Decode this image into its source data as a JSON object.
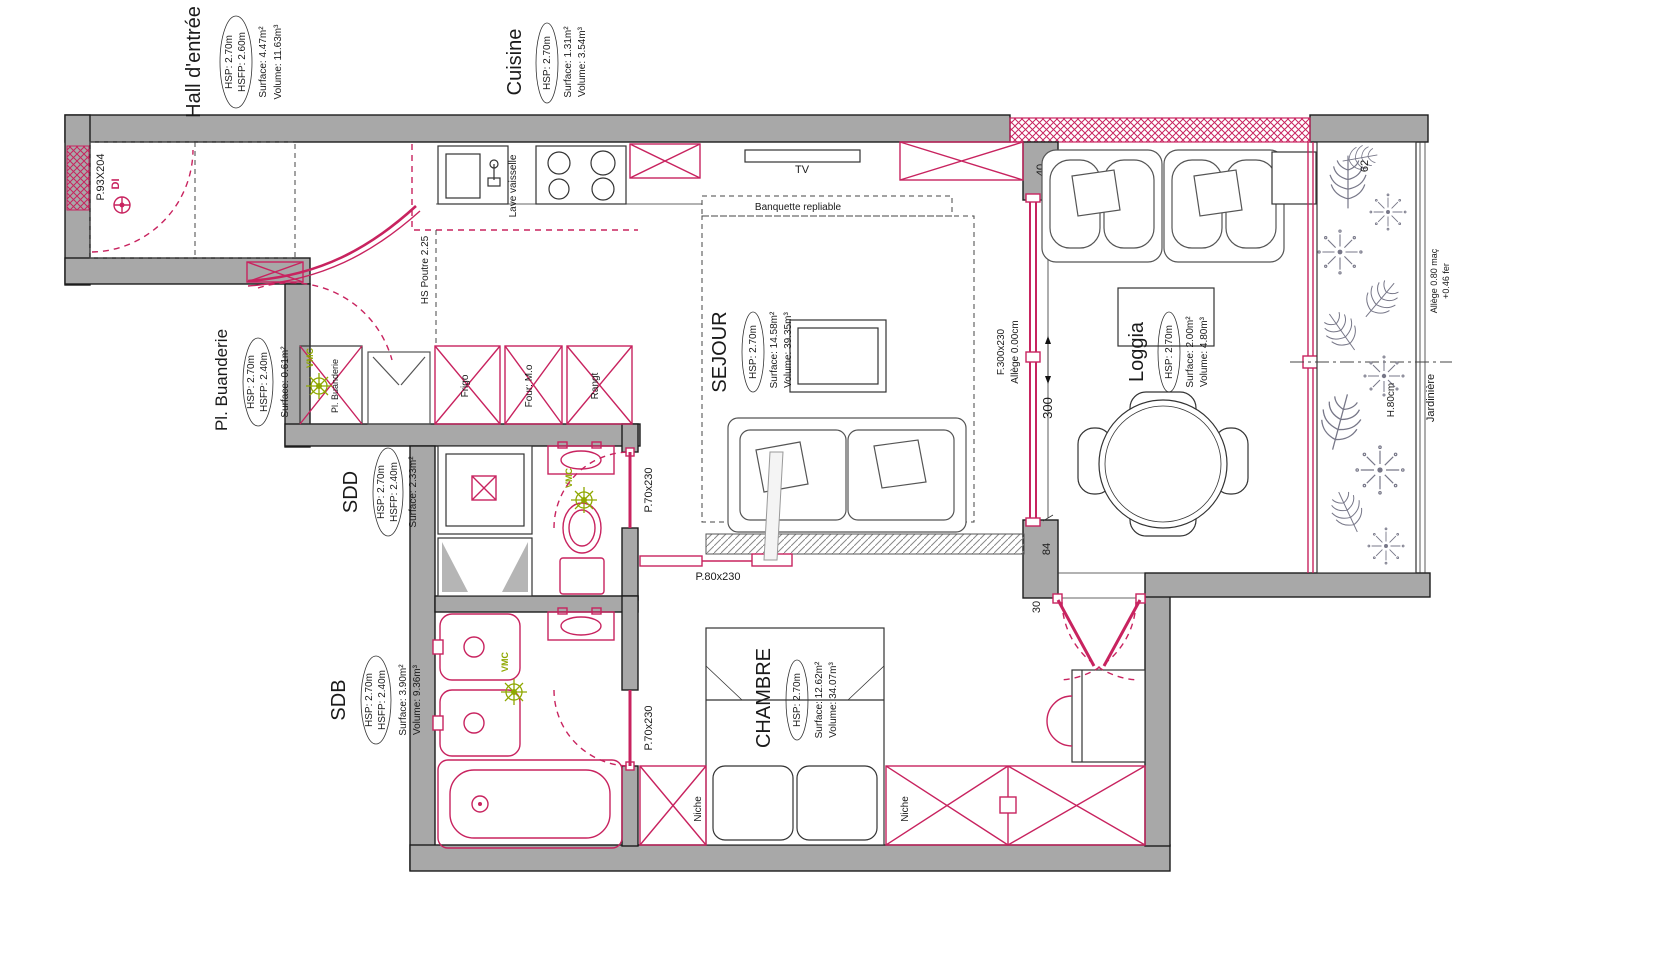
{
  "colors": {
    "accent_red": "#c8235f",
    "wall_gray": "#a8a8a8",
    "vmc_green": "#8fa800",
    "ink": "#1a1a1a"
  },
  "rooms": {
    "hall": {
      "name": "Hall d'entrée",
      "hsp": "HSP: 2.70m",
      "hsfp": "HSFP: 2.60m",
      "surface": "Surface: 4.47m²",
      "volume": "Volume: 11.63m³"
    },
    "cuisine": {
      "name": "Cuisine",
      "hsp": "HSP: 2.70m",
      "surface": "Surface: 1.31m²",
      "volume": "Volume: 3.54m³"
    },
    "buanderie": {
      "name": "Pl. Buanderie",
      "hsp": "HSP: 2.70m",
      "hsfp": "HSFP: 2.40m",
      "surface": "Surface: 0.61m²"
    },
    "sdd": {
      "name": "SDD",
      "hsp": "HSP: 2.70m",
      "hsfp": "HSFP: 2.40m",
      "surface": "Surface: 2.33m²"
    },
    "sdb": {
      "name": "SDB",
      "hsp": "HSP: 2.70m",
      "hsfp": "HSFP: 2.40m",
      "surface": "Surface: 3.90m²",
      "volume": "Volume: 9.36m³"
    },
    "sejour": {
      "name": "SEJOUR",
      "hsp": "HSP: 2.70m",
      "surface": "Surface: 14.58m²",
      "volume": "Volume: 39.35m³"
    },
    "loggia": {
      "name": "Loggia",
      "hsp": "HSP: 2.70m",
      "surface": "Surface: 2.00m²",
      "volume": "Volume: 4.80m³"
    },
    "chambre": {
      "name": "CHAMBRE",
      "hsp": "HSP: 2.70m",
      "surface": "Surface: 12.62m²",
      "volume": "Volume: 34.07m³"
    }
  },
  "labels": {
    "lave_vaisselle": "Lave vaisselle",
    "hs_poutre": "HS Poutre 2.25",
    "frigo": "Frigo",
    "four": "Four: M.o",
    "rangt": "Rangt",
    "pl_buanderie": "Pl. Buanderie",
    "vmc": "VMC",
    "tv": "TV",
    "banquette": "Banquette repliable",
    "niche": "Niche",
    "jardiniere": "Jardinière",
    "h80": "H.80cm"
  },
  "openings": {
    "entry_door": "P.93X204",
    "di": "DI",
    "door70": "P.70x230",
    "door80": "P.80x230",
    "window": "F.300x230",
    "allege0": "Allège 0.00cm",
    "allege80": "Allège 0.80 maç",
    "fer": "+0.46 fer"
  },
  "dims": {
    "d40": "40",
    "d300": "300",
    "d84": "84",
    "d30": "30",
    "d62": "62"
  }
}
